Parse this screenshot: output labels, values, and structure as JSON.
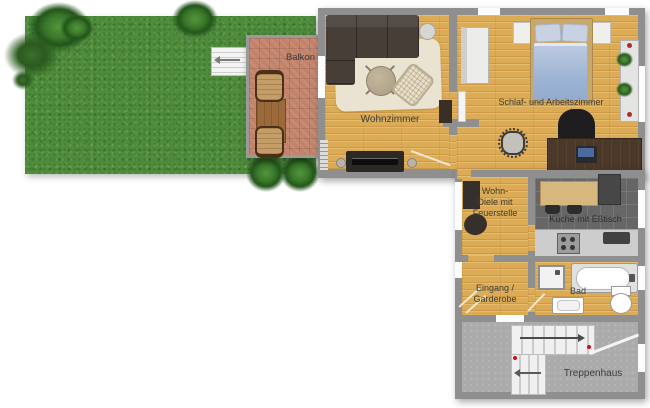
{
  "floorplan": {
    "rooms": {
      "balkon": {
        "label": "Balkon"
      },
      "wohnzimmer": {
        "label": "Wohnzimmer"
      },
      "schlafzimmer": {
        "label": "Schlaf- und Arbeitszimmer"
      },
      "wohndiele": {
        "line1": "Wohn-",
        "line2": "Diele mit",
        "line3": "Feuerstelle"
      },
      "kueche": {
        "label": "Küche mit Eßtisch"
      },
      "eingang": {
        "line1": "Eingang /",
        "line2": "Garderobe"
      },
      "bad": {
        "label": "Bad"
      },
      "treppenhaus": {
        "label": "Treppenhaus"
      }
    },
    "colors": {
      "grass": "#4e8c3c",
      "balcony_tile": "#c2836a",
      "wood_floor": "#dcab55",
      "kitchen_tile": "#666666",
      "stairwell_floor": "#ababab",
      "wall": "#8f8f8f",
      "sofa": "#463e37",
      "bed": "#a5bbd8",
      "rug": "#ebe3d1",
      "stair_arrow_red": "#cc1111"
    }
  }
}
